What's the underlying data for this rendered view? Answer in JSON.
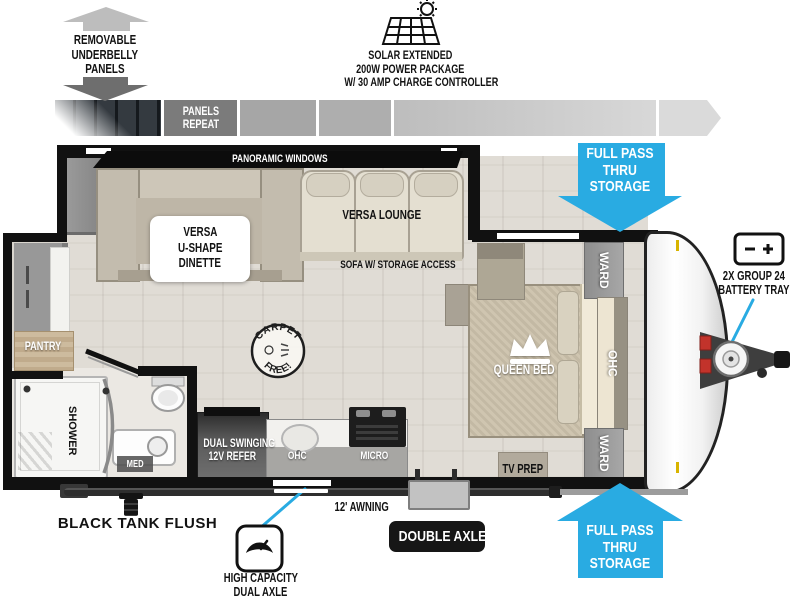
{
  "colors": {
    "cyan": "#29ABE2",
    "wall_black": "#111111",
    "floor": "#E0DCD5",
    "panels_gray": "#7B7B7B",
    "badge_black": "#161616"
  },
  "underbelly": {
    "lines": [
      "REMOVABLE",
      "UNDERBELLY",
      "PANELS"
    ]
  },
  "solar": {
    "lines": [
      "SOLAR EXTENDED",
      "200W POWER PACKAGE",
      "W/ 30 AMP CHARGE CONTROLLER"
    ]
  },
  "panels_repeat": {
    "lines": [
      "PANELS",
      "REPEAT"
    ]
  },
  "storage_top": {
    "lines": [
      "FULL PASS",
      "THRU",
      "STORAGE"
    ]
  },
  "storage_bottom": {
    "lines": [
      "FULL PASS",
      "THRU",
      "STORAGE"
    ]
  },
  "battery": {
    "lines": [
      "2X GROUP 24",
      "BATTERY TRAY"
    ]
  },
  "floorplan": {
    "panoramic_windows": "PANORAMIC WINDOWS",
    "dinette": {
      "lines": [
        "VERSA",
        "U-SHAPE",
        "DINETTE"
      ]
    },
    "versa_lounge": "VERSA LOUNGE",
    "sofa_storage": "SOFA W/ STORAGE ACCESS",
    "carpet_stamp": {
      "top": "CARPET",
      "bottom": "FREE!"
    },
    "queen_bed": "QUEEN BED",
    "ward_front": "WARD",
    "ohc_front": "OHC",
    "ward_rear": "WARD",
    "tv_prep": "TV PREP",
    "pantry": "PANTRY",
    "shower": "SHOWER",
    "med": "MED",
    "refer": {
      "lines": [
        "DUAL SWINGING",
        "12V REFER"
      ]
    },
    "kitchen_ohc": "OHC",
    "micro": "MICRO"
  },
  "bottom": {
    "black_tank_flush": "BLACK TANK FLUSH",
    "awning": "12' AWNING",
    "double_axle": "DOUBLE AXLE",
    "high_capacity": {
      "lines": [
        "HIGH CAPACITY",
        "DUAL AXLE"
      ]
    }
  },
  "icons": {
    "underbelly_up": "arrow-up-icon",
    "underbelly_down": "arrow-down-icon",
    "solar_panel": "solar-panel-sun-icon",
    "crown": "crown-icon",
    "scale": "axle-weight-scale-icon",
    "battery_symbol": "battery-minus-plus-icon",
    "carpet_stamp": "carpet-free-stamp-icon"
  }
}
